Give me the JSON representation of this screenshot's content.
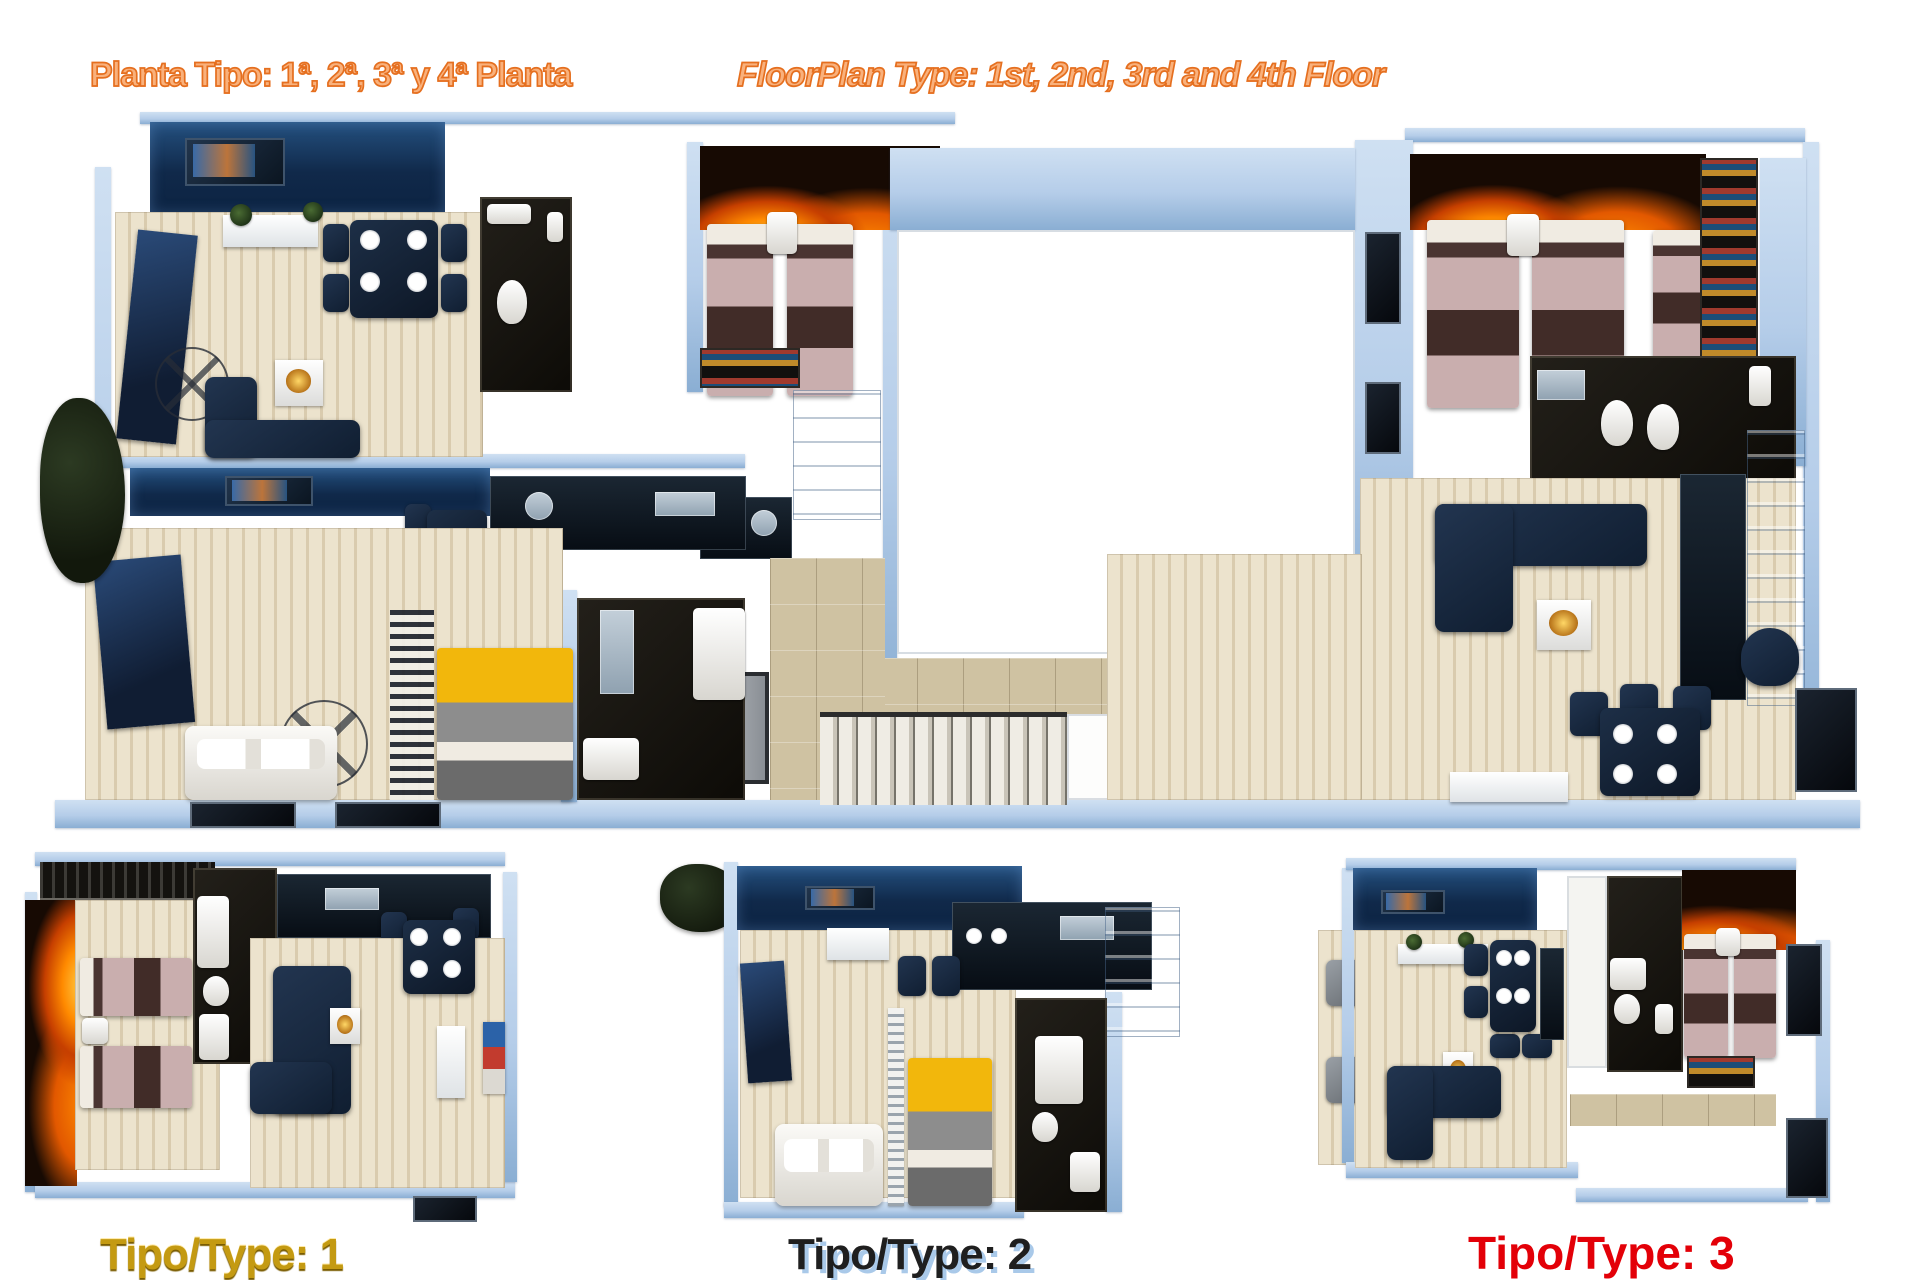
{
  "header": {
    "title_es": "Planta Tipo: 1ª, 2ª, 3ª y 4ª Planta",
    "title_en": "FloorPlan Type: 1st, 2nd, 3rd and 4th Floor"
  },
  "plans": {
    "main": {
      "name": "Planta Tipo / Floor plan types 1-3 combined"
    },
    "type1": {
      "label": "Tipo/Type: 1"
    },
    "type2": {
      "label": "Tipo/Type: 2"
    },
    "type3": {
      "label": "Tipo/Type: 3"
    }
  },
  "colors": {
    "orange-fill": "#f9b17c",
    "orange-stroke": "#e56f1f",
    "label-gold": "#c49a12",
    "label-gold-dark": "#7a5c00",
    "label-slate": "#1f1f1f",
    "label-slate-shadow": "#a9c9e9",
    "label-red": "#e30008",
    "wall-blue": "#b5cde9",
    "wall-blue-deep": "#8aaed3",
    "floor-beige1": "#ece3cd",
    "floor-beige2": "#d9cbae",
    "floor-tan": "#cfc2a2",
    "accent-navy1": "#24507f",
    "accent-navy2": "#0c2342",
    "fire-base": "#170a03",
    "fire-glow1": "#ffd34d",
    "fire-glow2": "#ff8a00",
    "fire-glow3": "#c63f00",
    "bed-pink": "#c9aeae",
    "bed-brown": "#412c28",
    "pillow-light": "#f0ebe2",
    "bed-yellow": "#f2b70c",
    "bed-gray": "#8d8d8d",
    "sofa-dark1": "#223550",
    "sofa-dark2": "#101e31",
    "sofa-white1": "#fbfaf7",
    "sofa-white2": "#d9d6cf",
    "bath1": "#23201a",
    "bath2": "#0d0b07",
    "fix1": "#ffffff",
    "fix2": "#d8d6d0",
    "kitchen1": "#1b2733",
    "kitchen2": "#070d14",
    "steel1": "#c3cfd9",
    "steel2": "#8fa1b0",
    "stair-light": "#efece4",
    "stair-mid": "#c9c4b8",
    "stair-dark": "#76736a",
    "plant1": "#4a6b33",
    "plant2": "#1f3317"
  }
}
